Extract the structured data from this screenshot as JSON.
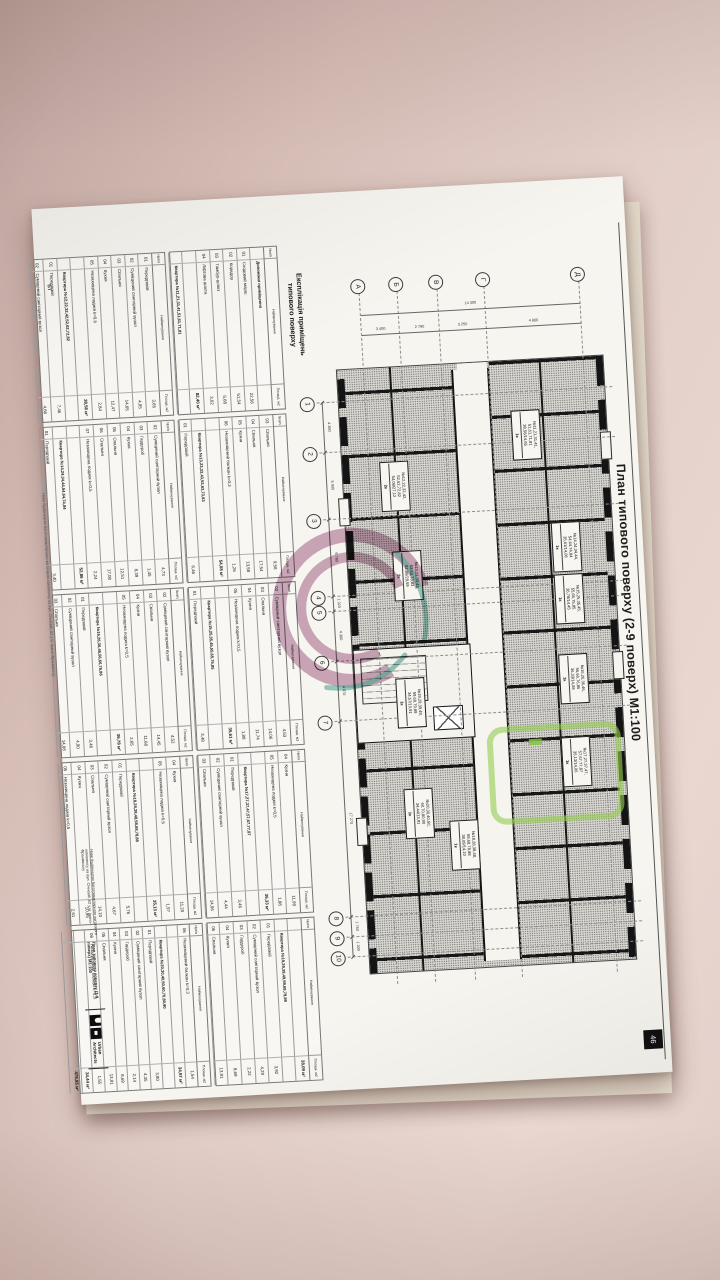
{
  "doc": {
    "title": "План типового поверху (2-9 поверх) М1:100",
    "sheet_number": "46",
    "stamp": "БТ",
    "explication": {
      "title_line1": "Експлікація приміщень",
      "title_line2": "типового поверху",
      "header": {
        "num": "№п/п",
        "name": "Найменування",
        "area": "Площа, м2"
      },
      "grand_total": "478,85 м²",
      "blocks": [
        {
          "title": "Допоміжні приміщення",
          "total": "82,40 м²",
          "rows": [
            [
              "01",
              "Сходовий марш",
              "22,56"
            ],
            [
              "02",
              "Коридор",
              "51,54"
            ],
            [
              "03",
              "Тамбур-шлюз",
              "5,68"
            ],
            [
              "04",
              "Ліфтова шахта",
              "3,02"
            ]
          ]
        },
        {
          "title": "Квартира №11,21,31,41,51,61,71,81",
          "total": "38,56 м²",
          "rows": [
            [
              "01",
              "Передпокій",
              "3,65"
            ],
            [
              "02",
              "Суміщений санітарний вузол",
              "4,95"
            ],
            [
              "03",
              "Спальня",
              "14,65"
            ],
            [
              "04",
              "Кухня",
              "12,47"
            ],
            [
              "05",
              "Незахищена лоджія k=0,5",
              "2,84"
            ]
          ]
        },
        {
          "title": "Квартира №12,22,32,42,52,62,72,82",
          "total": "54,08 м²",
          "rows": [
            [
              "01",
              "Передпокій",
              "7,46"
            ],
            [
              "02",
              "Суміщений санітарний вузол",
              "4,66"
            ],
            [
              "03",
              "Спальня",
              "9,58"
            ],
            [
              "04",
              "Спальня",
              "17,54"
            ],
            [
              "05",
              "Кухня",
              "13,58"
            ],
            [
              "06",
              "Незахищений балкон k=0,3",
              "1,26"
            ]
          ]
        },
        {
          "title": "Квартира №13,23,33,43,53,63,73,83",
          "total": "52,86 м²",
          "rows": [
            [
              "01",
              "Передпокій",
              "6,46"
            ],
            [
              "02",
              "Суміщений санітарний вузол",
              "4,73"
            ],
            [
              "03",
              "Гардероб",
              "1,45"
            ],
            [
              "04",
              "Кухня",
              "8,39"
            ],
            [
              "05",
              "Спальня",
              "12,51"
            ],
            [
              "06",
              "Спальня",
              "17,08"
            ],
            [
              "07",
              "Незахищена лоджія k=0,5",
              "2,24"
            ]
          ]
        },
        {
          "title": "Квартира №14,24,34,44,54,64,74,84",
          "total": "35,61 м²",
          "rows": [
            [
              "01",
              "Передпокій",
              "3,40"
            ],
            [
              "02",
              "Суміщений санітарний вузол",
              "4,53"
            ],
            [
              "03",
              "Спальня",
              "14,06"
            ],
            [
              "04",
              "Кухня",
              "11,74"
            ],
            [
              "05",
              "Незахищена лоджія k=0,5",
              "1,88"
            ]
          ]
        },
        {
          "title": "Квартира №15,25,35,45,55,65,75,85",
          "total": "36,78 м²",
          "rows": [
            [
              "01",
              "Передпокій",
              "3,48"
            ],
            [
              "02",
              "Суміщений санітарний вузол",
              "4,52"
            ],
            [
              "03",
              "Спальня",
              "14,45"
            ],
            [
              "04",
              "Кухня",
              "11,68"
            ],
            [
              "05",
              "Незахищена лоджія k=0,5",
              "2,65"
            ]
          ]
        },
        {
          "title": "Квартира №16,26,36,46,56,66,76,86",
          "total": "36,33 м²",
          "rows": [
            [
              "01",
              "Передпокій",
              "3,48"
            ],
            [
              "02",
              "Суміщений санітарний вузол",
              "4,90"
            ],
            [
              "03",
              "Спальня",
              "14,08"
            ],
            [
              "04",
              "Кухня",
              "11,99"
            ],
            [
              "05",
              "Незахищена лоджія k=0,5",
              "1,88"
            ]
          ]
        },
        {
          "title": "Квартира №17,27,37,47,57,67,77,87",
          "total": "35,13 м²",
          "rows": [
            [
              "01",
              "Передпокій",
              "3,46"
            ],
            [
              "02",
              "Суміщений санітарний вузол",
              "4,44"
            ],
            [
              "03",
              "Спальня",
              "14,06"
            ],
            [
              "04",
              "Кухня",
              "11,20"
            ],
            [
              "05",
              "Незахищена лоджія k=0,5",
              "1,97"
            ]
          ]
        },
        {
          "title": "Квартира №18,28,38,48,58,68,78,88",
          "total": "38,09 м²",
          "rows": [
            [
              "01",
              "Передпокій",
              "5,76"
            ],
            [
              "02",
              "Суміщений санітарний вузол",
              "4,67"
            ],
            [
              "03",
              "Спальня",
              "14,10"
            ],
            [
              "04",
              "Кухня",
              "10,95"
            ],
            [
              "05",
              "Незахищена лоджія k=0,5",
              "2,61"
            ]
          ]
        },
        {
          "title": "Квартира №19,29,39,49,59,69,79,89",
          "total": "34,57 м²",
          "rows": [
            [
              "01",
              "Передпокій",
              "3,92"
            ],
            [
              "02",
              "Суміщений санітарний вузол",
              "4,29"
            ],
            [
              "03",
              "Гардероб",
              "2,22"
            ],
            [
              "04",
              "Кухня",
              "8,69"
            ],
            [
              "05",
              "Спальня",
              "13,91"
            ],
            [
              "06",
              "Незахищений балкон k=0,3",
              "1,54"
            ]
          ]
        },
        {
          "title": "Квартира №20,30,40,50,60,70,80,90",
          "total": "34,44 м²",
          "rows": [
            [
              "01",
              "Передпокій",
              "3,80"
            ],
            [
              "02",
              "Суміщений санітарний вузол",
              "4,35"
            ],
            [
              "03",
              "Гардероб",
              "2,14"
            ],
            [
              "04",
              "Кухня",
              "8,69"
            ],
            [
              "05",
              "Спальня",
              "13,91"
            ],
            [
              "06",
              "Незахищений балкон k=0,3",
              "1,55"
            ]
          ]
        }
      ]
    },
    "plan": {
      "axes_numbers": [
        {
          "label": "1",
          "x": 203
        },
        {
          "label": "2",
          "x": 253
        },
        {
          "label": "3",
          "x": 320
        },
        {
          "label": "4",
          "x": 397
        },
        {
          "label": "5",
          "x": 412
        },
        {
          "label": "6",
          "x": 462
        },
        {
          "label": "7",
          "x": 522
        },
        {
          "label": "8",
          "x": 718
        },
        {
          "label": "9",
          "x": 738
        },
        {
          "label": "10",
          "x": 758
        }
      ],
      "dims_bottom": [
        "4 380",
        "5 900",
        "6 780",
        "1 320",
        "4 380",
        "4 070",
        "17 270",
        "1 760",
        "1 300"
      ],
      "axes_letters": [
        {
          "label": "Д",
          "y": 45
        },
        {
          "label": "Г",
          "y": 140
        },
        {
          "label": "В",
          "y": 187
        },
        {
          "label": "Б",
          "y": 227
        },
        {
          "label": "А",
          "y": 265
        }
      ],
      "dims_left": {
        "total": "14 300",
        "segments": [
          "4 860",
          "3 250",
          "2 790",
          "3 400"
        ]
      },
      "apartments": [
        {
          "n1": "№11,21,31,41,",
          "n2": "51,61,71,81",
          "area": "38,56/14,65",
          "rooms": "1к",
          "x": 222,
          "y": 92,
          "highlight": false
        },
        {
          "n1": "№14,24,34,44,",
          "n2": "54,64,74,84",
          "area": "35,61/14,06",
          "rooms": "1к",
          "x": 336,
          "y": 58,
          "highlight": false
        },
        {
          "n1": "№15,25,35,45,",
          "n2": "55,65,75,85",
          "area": "36,78/14,45",
          "rooms": "1к",
          "x": 388,
          "y": 58,
          "highlight": false
        },
        {
          "n1": "№16,26,36,46,",
          "n2": "56,66,76,86",
          "area": "36,33/14,08",
          "rooms": "1к",
          "x": 468,
          "y": 58,
          "highlight": false
        },
        {
          "n1": "№17,27,37,47,",
          "n2": "57,67,77,87",
          "area": "35,13/14,06",
          "rooms": "1к",
          "x": 551,
          "y": 60,
          "highlight": true
        },
        {
          "n1": "№12,22,32,42,",
          "n2": "52,62,72,82",
          "area": "54,08/27,12",
          "rooms": "2к",
          "x": 266,
          "y": 226,
          "highlight": false
        },
        {
          "n1": "№13,23,33,43,",
          "n2": "53,63,73,83",
          "area": "52,86/29,59",
          "rooms": "2к",
          "x": 356,
          "y": 218,
          "highlight": false
        },
        {
          "n1": "№19,29,39,49,",
          "n2": "59,69,79,89",
          "area": "34,57/13,91",
          "rooms": "1к",
          "x": 483,
          "y": 222,
          "highlight": false
        },
        {
          "n1": "№20,30,40,50,",
          "n2": "60,70,80,90",
          "area": "34,44/13,91",
          "rooms": "1к",
          "x": 594,
          "y": 220,
          "highlight": false
        },
        {
          "n1": "№18,28,38,48,",
          "n2": "58,68,78,88",
          "area": "38,09/14,10",
          "rooms": "1к",
          "x": 628,
          "y": 176,
          "highlight": false
        }
      ],
      "highlight_rect": {
        "x": 537,
        "y": 29,
        "w": 86,
        "h": 122
      },
      "highlight_dot": {
        "x": 551,
        "y": 108,
        "w": 6,
        "h": 13
      }
    },
    "title_block": {
      "project": "Нове будівництво багатоквартирного житлового комплексу на вул. Січневій, 62 у м. Івано-Франківську",
      "sheet_name": "План типового поверху (2-9 поверх)",
      "scale": "М1:100",
      "logo_caption1": "Urban",
      "logo_caption2": "Architects"
    },
    "footer_note": "Нове будівництво багатоквартирного житлового комплексу на вул. Січневій, 62 у м. Івано-Франківську"
  }
}
